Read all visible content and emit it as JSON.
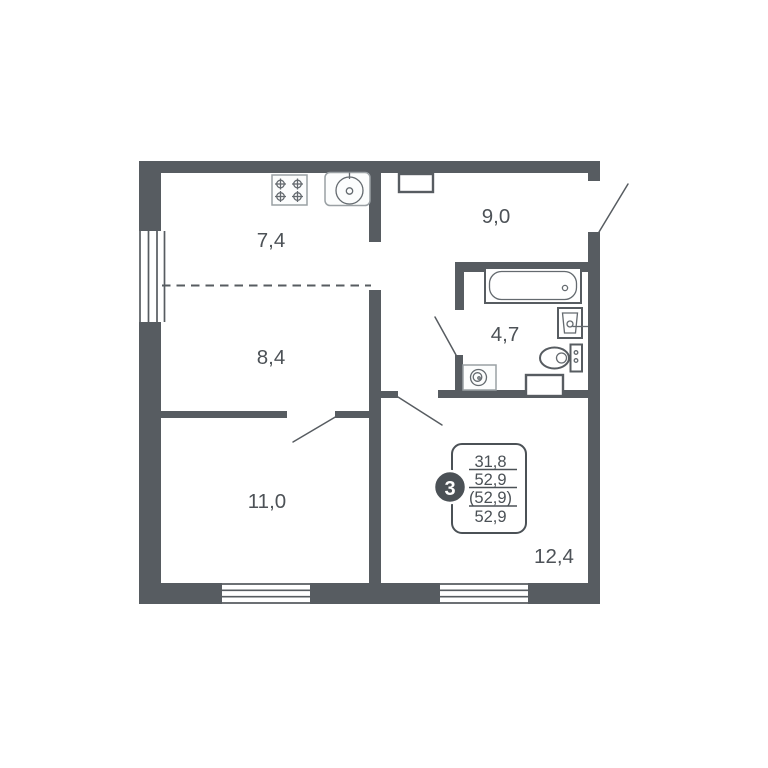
{
  "meta": {
    "type": "apartment-floor-plan"
  },
  "colors": {
    "wall": "#575c61",
    "fixture": "#9aa0a4",
    "fixture_dark": "#646a6f",
    "text": "#4d5257",
    "stamp": "#4b5156",
    "background": "#ffffff"
  },
  "rooms": [
    {
      "name": "kitchen",
      "area_label": "7,4"
    },
    {
      "name": "hallway",
      "area_label": "9,0"
    },
    {
      "name": "living-zone",
      "area_label": "8,4"
    },
    {
      "name": "bathroom",
      "area_label": "4,7"
    },
    {
      "name": "bedroom",
      "area_label": "11,0"
    },
    {
      "name": "main-room",
      "area_label": "12,4"
    }
  ],
  "stamp": {
    "rooms_number": "3",
    "row1": "31,8",
    "row2": "52,9",
    "row3": "(52,9)",
    "row4": "52,9"
  },
  "fixtures": {
    "stove": "stove-icon",
    "kitchen_sink": "kitchen-sink-icon",
    "bathtub": "bathtub-icon",
    "washbasin": "washbasin-icon",
    "toilet": "toilet-icon",
    "washing_machine": "washing-machine-icon",
    "vent_hall": "vent-shaft-icon",
    "vent_bath": "vent-shaft-icon"
  }
}
